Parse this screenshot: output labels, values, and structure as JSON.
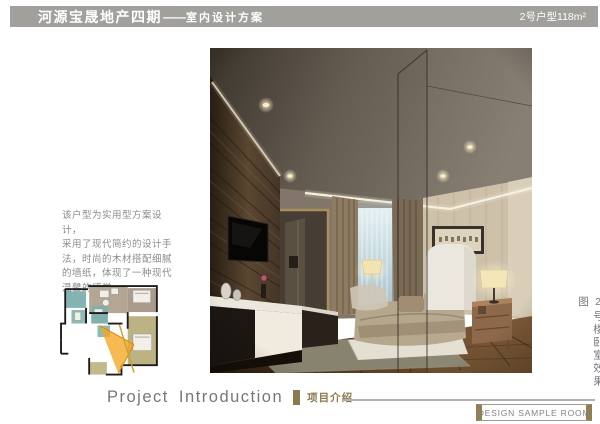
{
  "header": {
    "project_title": "河源宝晟地产四期",
    "dash": "——",
    "subtitle": "室内设计方案",
    "unit_label": "2号户型118m²"
  },
  "description": {
    "lines": [
      "该户型为实用型方案设计，",
      "采用了现代简约的设计手",
      "法，时尚的木材搭配细腻",
      "的墙纸，体现了一种现代",
      "温馨的感觉。"
    ]
  },
  "photo": {
    "caption_vertical": "2号楼卧室效果图"
  },
  "footer": {
    "section_title_en": "Project  Introduction",
    "section_title_cn": "项目介绍",
    "stamp": "DESIGN SAMPLE ROOM"
  },
  "colors": {
    "header_bar": "#a2a09c",
    "accent_bronze": "#8a7a4e",
    "text_gray": "#8b8b8b",
    "plan_taupe": "#b3a695",
    "plan_teal": "#84b4b1",
    "plan_khaki": "#bcb283",
    "view_cone_orange": "#f5a623"
  }
}
